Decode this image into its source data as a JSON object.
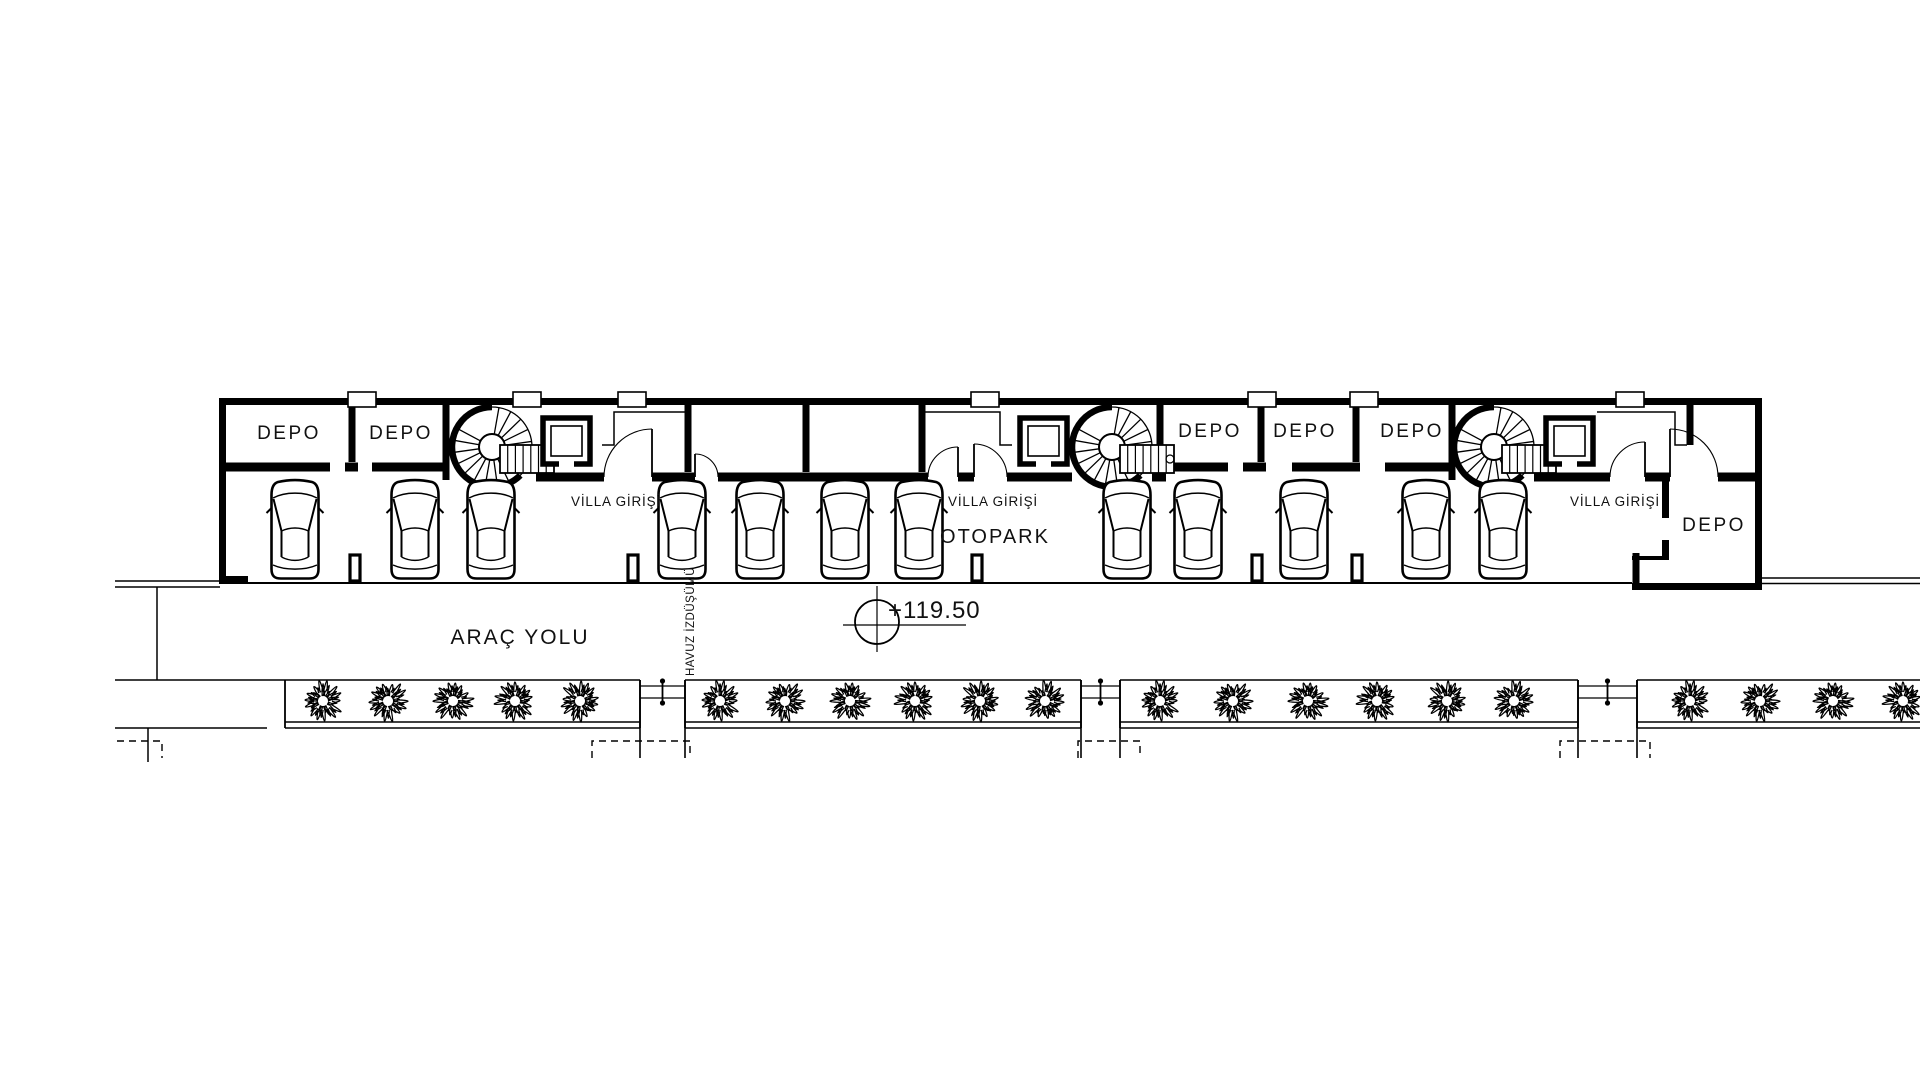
{
  "page": {
    "background": "#ffffff",
    "ink": "#000000"
  },
  "plan": {
    "room_labels": [
      {
        "text": "DEPO",
        "x": 289,
        "y": 439,
        "size": 19
      },
      {
        "text": "DEPO",
        "x": 401,
        "y": 439,
        "size": 19
      },
      {
        "text": "DEPO",
        "x": 1210,
        "y": 437,
        "size": 19
      },
      {
        "text": "DEPO",
        "x": 1305,
        "y": 437,
        "size": 19
      },
      {
        "text": "DEPO",
        "x": 1412,
        "y": 437,
        "size": 19
      },
      {
        "text": "DEPO",
        "x": 1714,
        "y": 531,
        "size": 19
      }
    ],
    "entrance_labels": [
      {
        "text": "VİLLA GİRİŞİ",
        "x": 616,
        "y": 506,
        "size": 13.5
      },
      {
        "text": "VİLLA GİRİŞİ",
        "x": 993,
        "y": 506,
        "size": 13.5
      },
      {
        "text": "VİLLA GİRİŞİ",
        "x": 1615,
        "y": 506,
        "size": 13.5
      }
    ],
    "area_labels": [
      {
        "text": "OTOPARK",
        "x": 995,
        "y": 543,
        "size": 20,
        "spacing": 2
      },
      {
        "text": "ARAÇ YOLU",
        "x": 520,
        "y": 644,
        "size": 21,
        "spacing": 2
      }
    ],
    "pool_label": {
      "text": "HAVUZ İZDÜŞÜMÜ",
      "x": 694,
      "y": 676,
      "size": 11.5
    },
    "elevation": {
      "text": "+119.50",
      "cx": 877,
      "cy": 622,
      "r": 22,
      "line_y": 625,
      "line_x1": 843,
      "line_x2": 966,
      "tick_y1": 586,
      "tick_y2": 652,
      "text_x": 888,
      "text_y": 618,
      "size": 24
    },
    "cars": {
      "cy": 530,
      "xs": [
        295,
        415,
        491,
        682,
        760,
        845,
        919,
        1127,
        1198,
        1304,
        1426,
        1503
      ]
    },
    "columns": {
      "y": 555,
      "w": 10,
      "h": 26,
      "xs": [
        355,
        633,
        977,
        1257,
        1357
      ]
    },
    "vents": {
      "y": 392,
      "w": 28,
      "h": 15,
      "xs": [
        362,
        527,
        632,
        985,
        1262,
        1364,
        1630
      ]
    },
    "spiral_stairs": [
      {
        "cx": 492,
        "cy": 447
      },
      {
        "cx": 1112,
        "cy": 447
      },
      {
        "cx": 1494,
        "cy": 447
      }
    ],
    "elevators": [
      {
        "x": 543,
        "y": 418
      },
      {
        "x": 1020,
        "y": 418
      },
      {
        "x": 1546,
        "y": 418
      }
    ],
    "doors": [
      [
        652,
        477,
        48,
        -1
      ],
      [
        695,
        477,
        23,
        1
      ],
      [
        958,
        477,
        30,
        -1
      ],
      [
        974,
        477,
        33,
        1
      ],
      [
        1645,
        477,
        35,
        -1
      ],
      [
        1670,
        477,
        48,
        1
      ]
    ],
    "planters": {
      "box_top": 680,
      "box_bottom": 722,
      "base_line": 728,
      "edge_drop": 758,
      "strips": [
        {
          "x1": 285,
          "x2": 640,
          "shrubs": [
            323,
            388,
            453,
            515,
            580
          ]
        },
        {
          "x1": 685,
          "x2": 1081,
          "shrubs": [
            720,
            785,
            850,
            915,
            980,
            1045
          ]
        },
        {
          "x1": 1120,
          "x2": 1578,
          "shrubs": [
            1160,
            1233,
            1308,
            1377,
            1447,
            1514
          ]
        },
        {
          "x1": 1637,
          "x2": 1926,
          "shrubs": [
            1690,
            1760,
            1833,
            1903
          ]
        }
      ],
      "connectors": [
        {
          "x1": 640,
          "x2": 685
        },
        {
          "x1": 1081,
          "x2": 1120
        },
        {
          "x1": 1578,
          "x2": 1637
        }
      ],
      "dashed_boxes": [
        [
          592,
          690
        ],
        [
          1078,
          1140
        ],
        [
          1560,
          1650
        ]
      ],
      "dashed_y1": 741,
      "dashed_y2": 758,
      "left_dashed": [
        117,
        162
      ]
    }
  }
}
